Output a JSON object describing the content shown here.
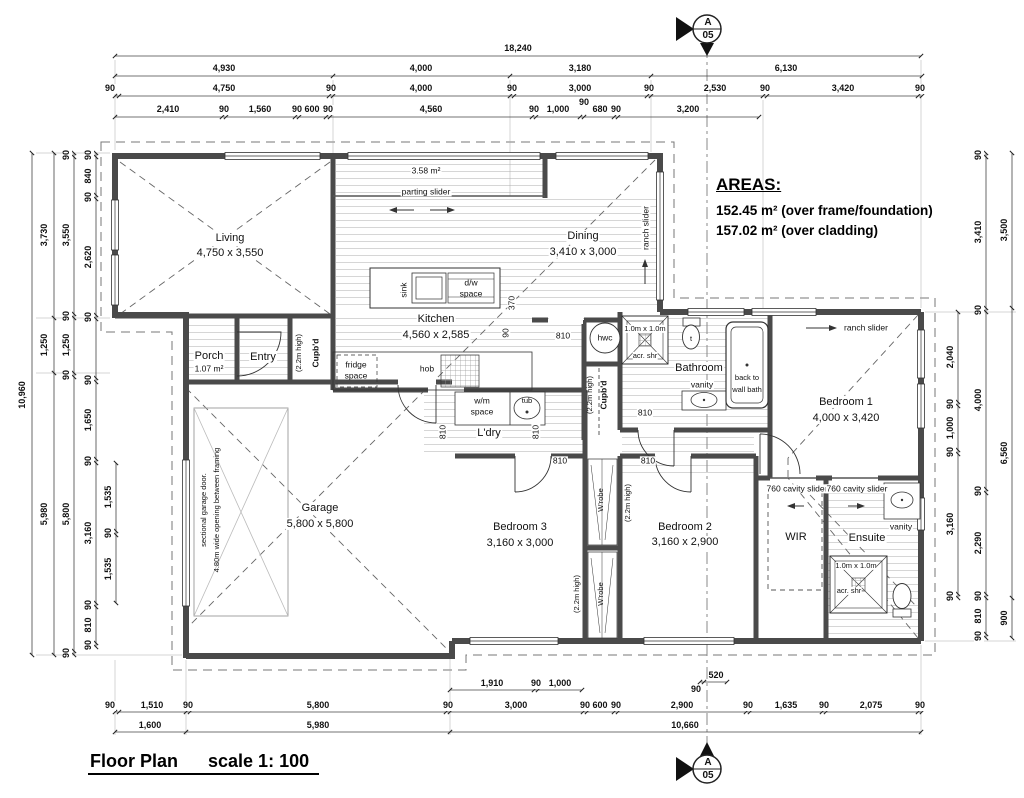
{
  "title": {
    "main": "Floor Plan",
    "scale": "scale 1: 100"
  },
  "areas": {
    "heading": "AREAS:",
    "line1": "152.45 m² (over frame/foundation)",
    "line2": "157.02 m² (over cladding)"
  },
  "section_markers": {
    "top": {
      "letter": "A",
      "sheet": "05"
    },
    "bottom": {
      "letter": "A",
      "sheet": "05"
    }
  },
  "dims": {
    "top1": [
      "18,240"
    ],
    "top2": [
      "4,930",
      "4,000",
      "3,180",
      "6,130"
    ],
    "top3": [
      "90",
      "4,750",
      "90",
      "4,000",
      "90",
      "3,000",
      "90",
      "2,530",
      "90",
      "3,420",
      "90"
    ],
    "top4": [
      "2,410",
      "90",
      "1,560",
      "90",
      "600",
      "90",
      "4,560",
      "90",
      "1,000",
      "90",
      "680",
      "90",
      "3,200"
    ],
    "left1": [
      "10,960"
    ],
    "left2": [
      "3,730",
      "1,250",
      "5,980"
    ],
    "left3": [
      "90",
      "3,550",
      "90",
      "1,250",
      "90",
      "5,800",
      "90"
    ],
    "left4": [
      "90",
      "840",
      "90",
      "2,620",
      "90",
      "90",
      "1,650",
      "90",
      "3,160",
      "90",
      "810",
      "90"
    ],
    "left5": [
      "1,535",
      "90",
      "1,535"
    ],
    "right_inner": [
      "2,040",
      "90",
      "1,000",
      "90",
      "3,160",
      "90"
    ],
    "right_middle": [
      "90",
      "3,410",
      "90",
      "4,000",
      "90",
      "2,290",
      "90",
      "810",
      "90"
    ],
    "right_outer": [
      "3,500",
      "6,560",
      "900"
    ],
    "bottom_detail": [
      "1,910",
      "90",
      "1,000"
    ],
    "bottom_step": [
      "90",
      "520"
    ],
    "bottom2": [
      "90",
      "1,510",
      "90",
      "5,800",
      "90",
      "3,000",
      "90",
      "600",
      "90",
      "2,900",
      "90",
      "1,635",
      "90",
      "2,075",
      "90"
    ],
    "bottom3": [
      "1,600",
      "5,980",
      "10,660"
    ],
    "interior_h": [
      "810",
      "810",
      "810",
      "810"
    ],
    "interior_v": [
      "810",
      "810",
      "370",
      "90"
    ]
  },
  "rooms": {
    "living": {
      "name": "Living",
      "size": "4,750 x 3,550"
    },
    "dining": {
      "name": "Dining",
      "size": "3,410 x 3,000"
    },
    "kitchen": {
      "name": "Kitchen",
      "size": "4,560 x 2,585"
    },
    "garage": {
      "name": "Garage",
      "size": "5,800 x 5,800"
    },
    "bedroom1": {
      "name": "Bedroom 1",
      "size": "4,000 x 3,420"
    },
    "bedroom2": {
      "name": "Bedroom 2",
      "size": "3,160 x 2,900"
    },
    "bedroom3": {
      "name": "Bedroom 3",
      "size": "3,160 x 3,000"
    },
    "porch": {
      "name": "Porch",
      "area": "1.07 m²"
    },
    "entry": {
      "name": "Entry"
    },
    "laundry": {
      "name": "L'dry"
    },
    "bathroom": {
      "name": "Bathroom"
    },
    "ensuite": {
      "name": "Ensuite"
    },
    "wir": {
      "name": "WIR"
    },
    "deck": {
      "area": "3.58 m²"
    }
  },
  "labels": {
    "parting_slider": "parting slider",
    "ranch_slider_dining": "ranch slider",
    "ranch_slider_bed1": "ranch slider",
    "cavity_slider_left": "760 cavity slider",
    "cavity_slider_right": "760 cavity slider",
    "sink": "sink",
    "dw1": "d/w",
    "dw2": "space",
    "fridge1": "fridge",
    "fridge2": "space",
    "hob": "hob",
    "wm1": "w/m",
    "wm2": "space",
    "tub": "tub",
    "hwc": "hwc",
    "cupbd_entry": "Cupb'd",
    "cupbd_hall": "Cupb'd",
    "high_entry": "(2.2m high)",
    "high_hall": "(2.2m high)",
    "high_robe1": "(2.2m high)",
    "high_robe2": "(2.2m high)",
    "wrobe1": "W'robe",
    "wrobe2": "W'robe",
    "shower_bath1": "1.0m x 1.0m",
    "shower_bath2": "acr. shr",
    "shower_ens1": "1.0m x 1.0m",
    "shower_ens2": "acr. shr",
    "vanity_bath": "vanity",
    "vanity_ens": "vanity",
    "bath1": "back to",
    "bath2": "wall bath",
    "toilet_t": "t",
    "garage_door1": "sectional garage door.",
    "garage_door2": "4.80m wide opening between framing"
  }
}
